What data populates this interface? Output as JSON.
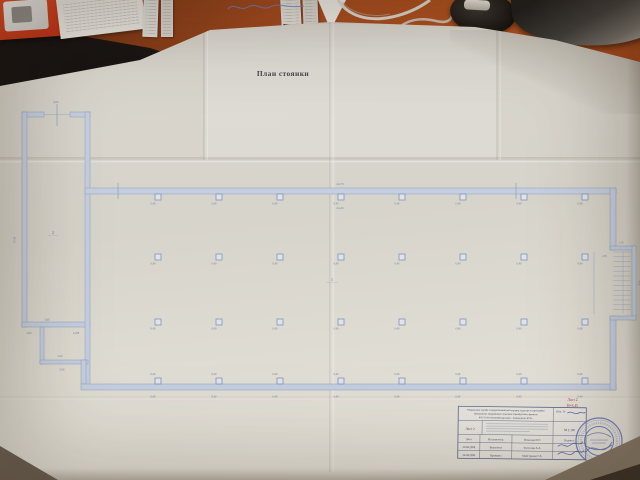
{
  "photo": {
    "colors": {
      "desk": "#a0440f",
      "paper": "#d9d6ce",
      "plan_line": "#8ea3c2",
      "stamp_blue": "#5f6fb8",
      "annotation_red": "#b2423a",
      "pen_blue": "#6b7fc9"
    }
  },
  "plan": {
    "title": "План стоянки",
    "room_labels": {
      "hall": "1",
      "annex": "2"
    },
    "column_size_label": "0,40",
    "dims": {
      "top_outer": "44,70",
      "top_inner": "44,26",
      "annex_width": "6,06",
      "annex_height": "17,58",
      "stair_top": "1,79",
      "stair_inner": "1,38",
      "stair_side": "4,26",
      "bottom_left_1": "5,60",
      "bottom_left_2": "2,60",
      "bottom_left_3": "12,08",
      "bottom_left_4": "5,04",
      "bottom_left_5": "3,56"
    }
  },
  "title_block": {
    "org_line1": "Федеральная служба государственной регистрации, кадастра и картографии",
    "org_line2": "Центральное межрайонное отделение Оренбургского филиала",
    "org_line3": "ФГУП «Ростехинвентаризация – Федеральное БТИ»",
    "sheet_label": "Лист 2",
    "scale": "М 1:100",
    "inventory_label": "Инв. №",
    "red_sheet_note": "Лист 2",
    "red_height_note": "Н=3,45",
    "table": {
      "headers": [
        "Дата",
        "Исполнитель",
        "Фамилия И.О.",
        "Подпись"
      ],
      "rows": [
        {
          "date": "26.04.2008",
          "role": "Выполнил",
          "name": "Фетисова А.А."
        },
        {
          "date": "26.04.2008",
          "role": "Проверил",
          "name": "Майстренко Г.А."
        }
      ]
    }
  }
}
